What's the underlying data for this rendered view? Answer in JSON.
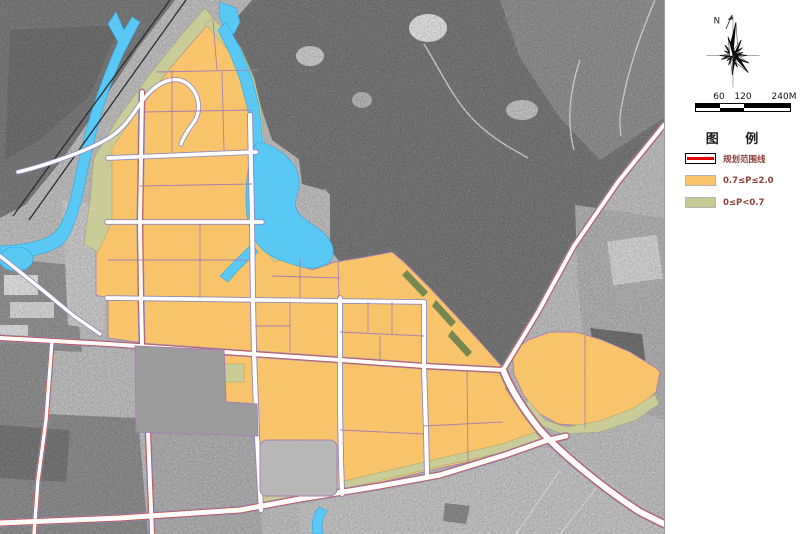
{
  "panel": {
    "compass": {
      "north_label": "N"
    },
    "scale_bar": {
      "tick_labels": {
        "t60": "60",
        "t120": "120",
        "t240": "240M"
      }
    },
    "legend": {
      "title": "图 例",
      "items": [
        {
          "label": "规划范围线",
          "swatch": "boundary-line"
        },
        {
          "label": "0.7≤P≤2.0",
          "swatch": "zone-high"
        },
        {
          "label": "0≤P<0.7",
          "swatch": "zone-low"
        }
      ]
    }
  },
  "map": {
    "colors": {
      "zone_high": "#F8C369",
      "zone_low": "#C9CB97",
      "water": "#57C7F5",
      "road_casing": "#8F86BB",
      "road_center_red": "#D0493A",
      "parcel_line": "#A77FB0",
      "boundary_red": "#E60000"
    }
  }
}
